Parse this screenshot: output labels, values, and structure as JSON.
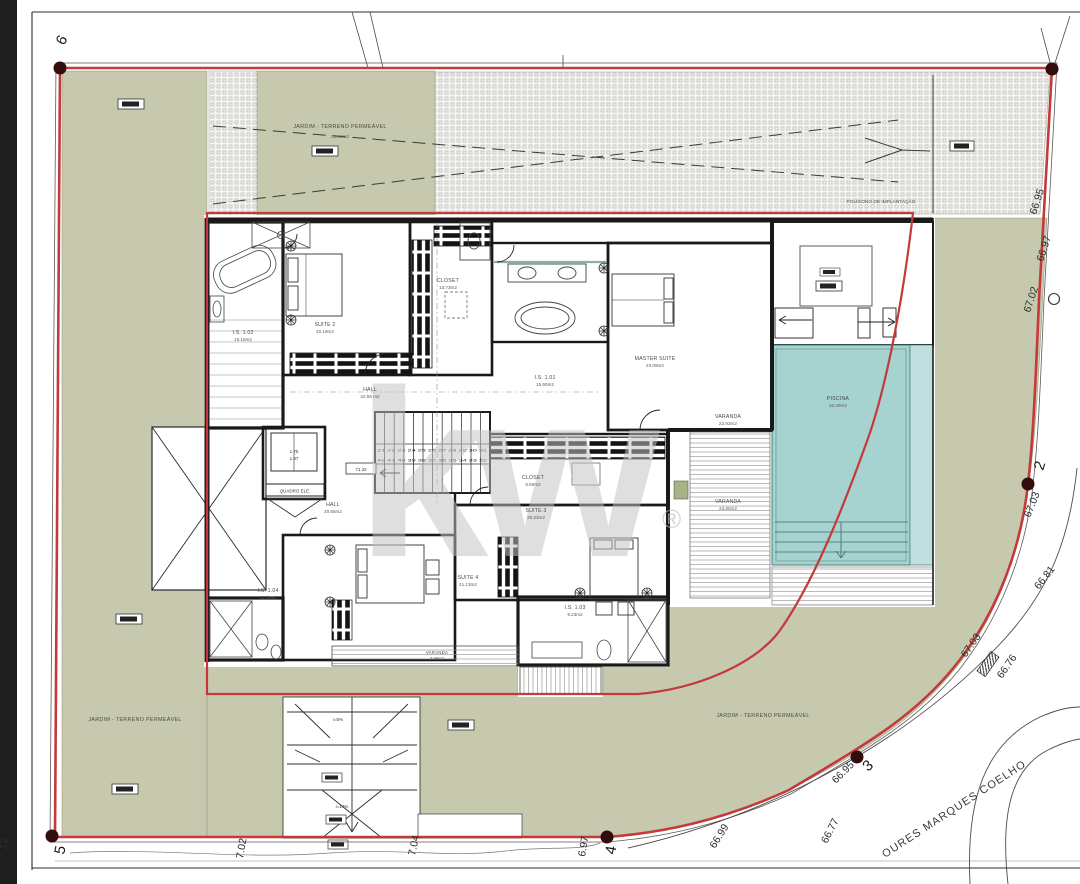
{
  "watermark": {
    "logo": "kw",
    "reg": "®"
  },
  "site": {
    "garden": "JARDIM - TERRENO PERMEÁVEL",
    "garden_area": "22.98m2",
    "implantation": "POLÍGONO DE IMPLANTAÇÃO",
    "street": "OURES MARQUES COELHO"
  },
  "markers": {
    "m2": "2",
    "m3": "3",
    "m4": "4",
    "m5": "5",
    "m6": "6"
  },
  "elev": [
    "66.95",
    "66.97",
    "67.02",
    "67.03",
    "66.81",
    "67.03",
    "66.76",
    "66.95",
    "66.99",
    "66.77",
    "6.97",
    "7.04",
    "7.02",
    "7.12"
  ],
  "stairs": {
    "row1": "21 22 23 24 25 26 27 28 29 30 31",
    "row2": "42 41 40 39 38 37 36 35 34 33 32",
    "level": "71.32"
  },
  "elevator": {
    "w": "1.75",
    "d": "1.97",
    "board": "QUADRO ELE."
  },
  "ramp": {
    "s1": "i=5%",
    "s2": "i=14%"
  },
  "rooms": {
    "bath1": {
      "name": "I.S. 1.02",
      "area": "16.15m2"
    },
    "suite2": {
      "name": "SUITE 2",
      "area": "20.19m2"
    },
    "closet1": {
      "name": "CLOSET",
      "area": "13.73m2"
    },
    "hall_upper": {
      "name": "HALL",
      "area": "22.56 m2"
    },
    "bath_master": {
      "name": "I.S. 1.01",
      "area": "15.90m2"
    },
    "master": {
      "name": "MASTER SUITE",
      "area": "23.09m2"
    },
    "varanda_master": {
      "name": "VARANDA",
      "area": "22.93m2"
    },
    "closet2": {
      "name": "CLOSET",
      "area": "9.60m2"
    },
    "suite3": {
      "name": "SUITE 3",
      "area": "25.33m2"
    },
    "suite4": {
      "name": "SUITE 4",
      "area": "21.13m2"
    },
    "bath2": {
      "name": "I.S. 1.03",
      "area": "9.23m2"
    },
    "bath3": {
      "name": "I.S. 1.04",
      "area": "12.26m2"
    },
    "hall_lower": {
      "name": "HALL",
      "area": "20.55m2"
    },
    "varanda_bottom": {
      "name": "VARANDA",
      "area": "7.98m2"
    },
    "varanda_suite3": {
      "name": "VARANDA",
      "area": "23.80m2"
    },
    "pool": {
      "name": "PISCINA",
      "area": "32.29m2"
    }
  }
}
